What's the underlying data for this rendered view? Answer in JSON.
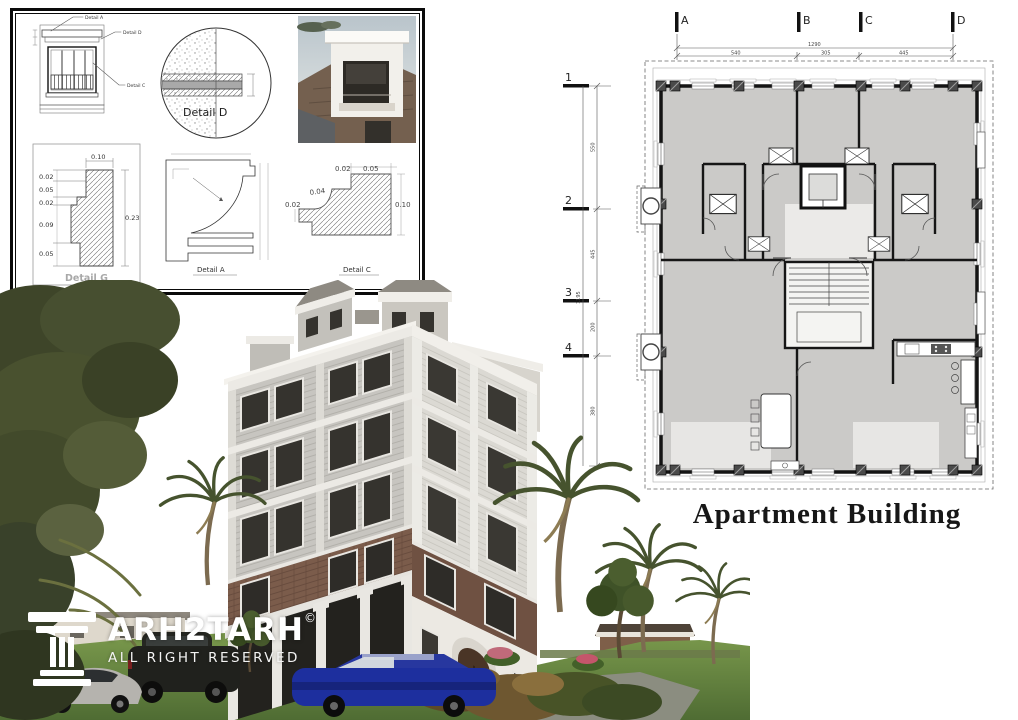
{
  "canvas": {
    "width": 1018,
    "height": 720,
    "background": "#ffffff"
  },
  "detail_panel": {
    "elevation": {
      "callouts": [
        "Detail A",
        "Detail D",
        "Detail C"
      ]
    },
    "detail_d": {
      "label": "Detail  D"
    },
    "detail_g": {
      "label": "Detail G",
      "dim_top": "0.10",
      "dim_right": "0.23",
      "dims_left": [
        "0.02",
        "0.05",
        "0.02",
        "0.09",
        "0.05"
      ]
    },
    "detail_a": {
      "label": "Detail A"
    },
    "detail_c": {
      "label": "Detail C",
      "dim_top_left": "0.02",
      "dim_top_right": "0.05",
      "dim_curve": "0.04",
      "dim_left": "0.02",
      "dim_right": "0.10"
    }
  },
  "floor_plan": {
    "title": "Apartment Building",
    "grid_columns": [
      "A",
      "B",
      "C",
      "D"
    ],
    "grid_rows": [
      "1",
      "2",
      "3",
      "4"
    ],
    "top_dimensions": {
      "total": "1290",
      "segments": [
        "540",
        "305",
        "445"
      ]
    },
    "left_dimensions": {
      "total": "1195",
      "segments": [
        "550",
        "445",
        "200",
        "380"
      ]
    }
  },
  "watermark": {
    "brand": "TARH2TARH",
    "brand_text": "ARH2TARH",
    "copyright_symbol": "©",
    "tagline": "ALL RIGHT RESERVED"
  },
  "colors": {
    "plan_fill": "#cbcac8",
    "wall": "#141414",
    "brick": "#7b5c4b",
    "lawn": "#5f803e",
    "foliage": "#454d2d",
    "logo_text": "#ffffff",
    "title_text": "#171717"
  }
}
